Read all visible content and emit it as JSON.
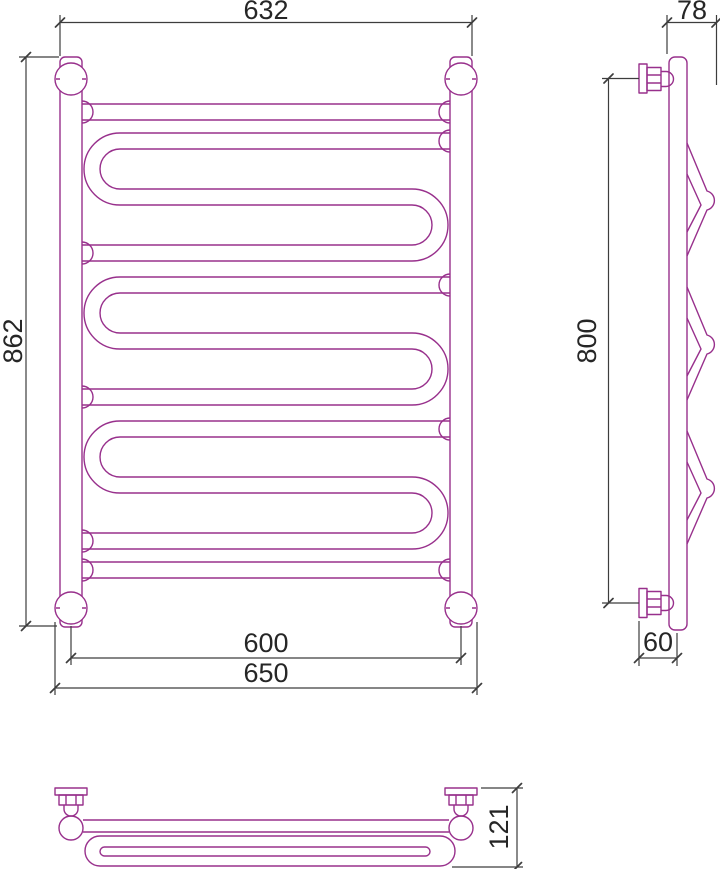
{
  "dimensions": {
    "front_width": "632",
    "front_height": "862",
    "bottom_center_width": "600",
    "bottom_overall_width": "650",
    "side_depth": "78",
    "side_height": "800",
    "side_bottom_offset": "60",
    "plan_depth": "121"
  },
  "colors": {
    "product_line": "#98308C",
    "dimension_line": "#3d3d3d",
    "text": "#262626",
    "background": "#ffffff"
  }
}
